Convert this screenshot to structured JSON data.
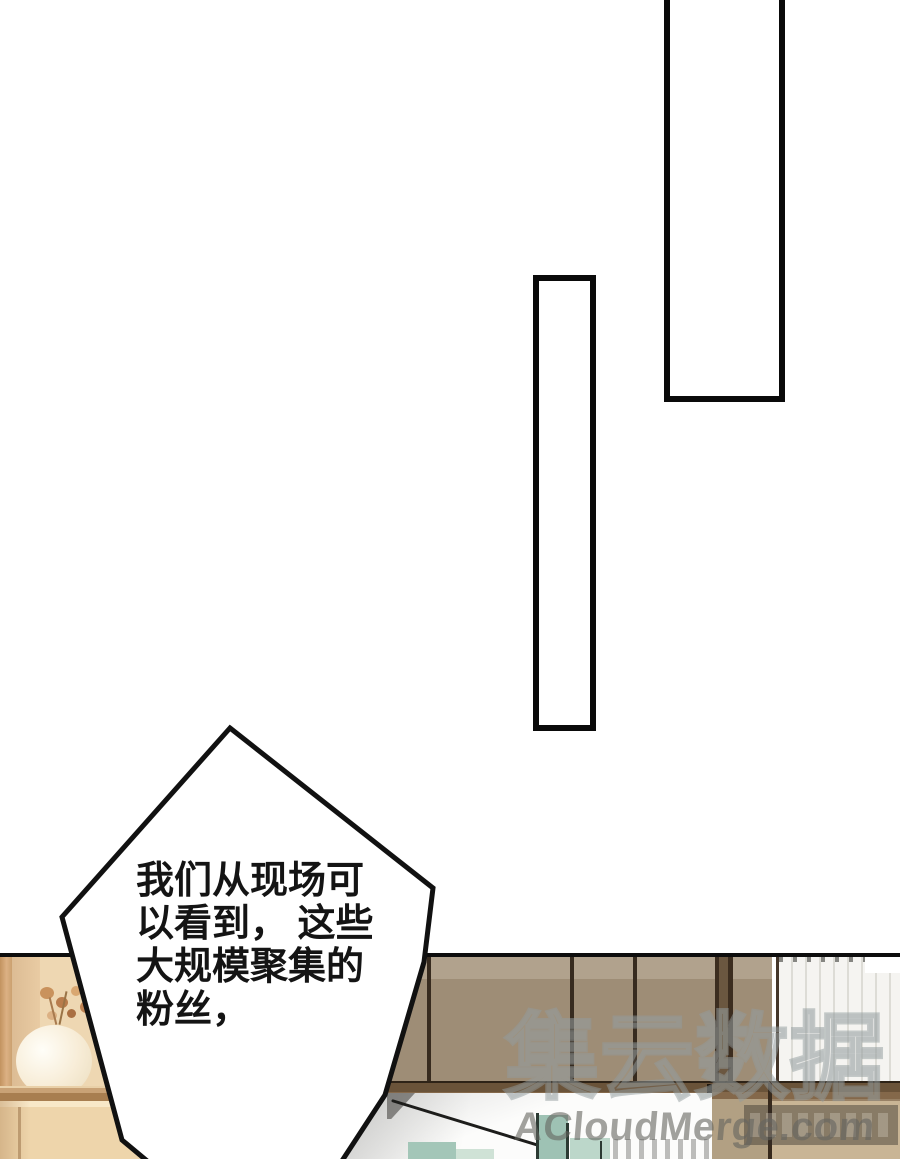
{
  "bubble": {
    "lines": [
      "我们从现场可",
      "以看到， 这些",
      "大规模聚集的",
      "粉丝，"
    ]
  },
  "watermark": {
    "logo_glyphs": "集云数据",
    "site_text": "ACloudMerge.com"
  },
  "colors": {
    "panel_border": "#0a0a0a",
    "cabinet_wood": "#9e8d76",
    "shelf_wood": "#d9b58e",
    "niche": "#eed7b2",
    "drawer": "#eed5ab",
    "mid_band": "#6a5339",
    "curtain": "#f5f4f1",
    "blanket": "#fcfcfb",
    "glass_teal": "#a3c6b8",
    "watermark_gray": "#8f9ea1"
  }
}
